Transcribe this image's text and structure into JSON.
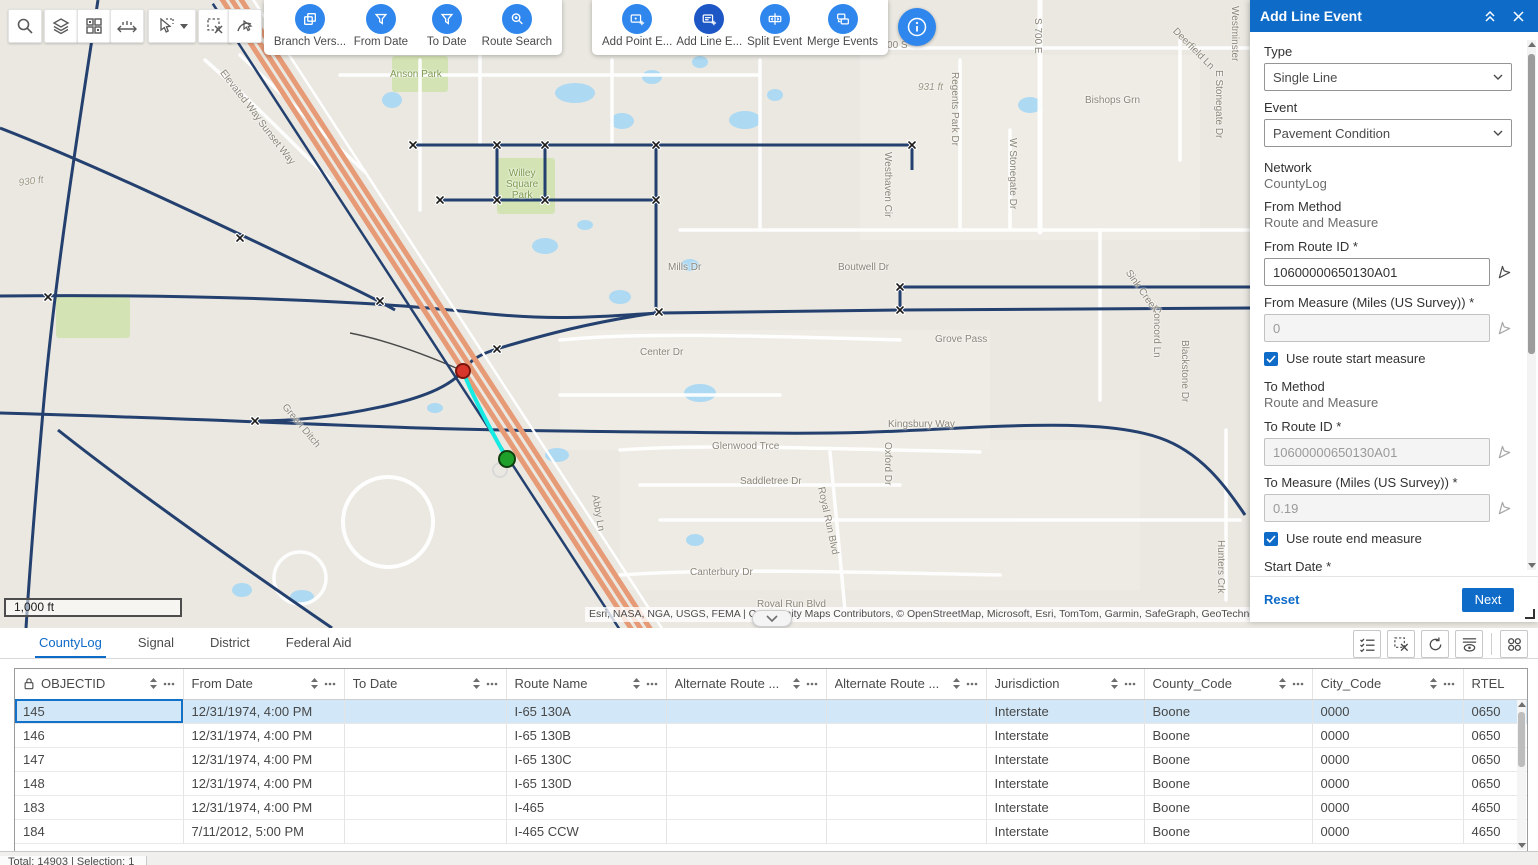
{
  "colors": {
    "accent_blue": "#0e6bc8",
    "toolbar_circle_blue": "#2f87ee",
    "active_circle_blue": "#1d56c5",
    "selected_row": "#d2e8f8",
    "route_navy": "#24406f",
    "highway_orange": "#e69a76",
    "selection_cyan": "#17e9e3",
    "marker_red": "#d8362a",
    "marker_green": "#1ea02b"
  },
  "map": {
    "scale_label": "1,000 ft",
    "attribution": "Esri, NASA, NGA, USGS, FEMA | Community Maps Contributors, © OpenStreetMap, Microsoft, Esri, TomTom, Garmin, SafeGraph, GeoTechnol",
    "labels": [
      {
        "text": "930 ft",
        "x": 18,
        "y": 178,
        "rot": -8,
        "cls": "elev"
      },
      {
        "text": "931 ft",
        "x": 918,
        "y": 82,
        "rot": 0,
        "cls": "elev"
      },
      {
        "text": "Elevated Way",
        "x": 226,
        "y": 68,
        "rot": 52,
        "cls": ""
      },
      {
        "text": "Sunset Way",
        "x": 264,
        "y": 118,
        "rot": 52,
        "cls": ""
      },
      {
        "text": "Anson Park",
        "x": 390,
        "y": 69,
        "rot": 0,
        "cls": "park"
      },
      {
        "text": "Willey\nSquare\nPark",
        "x": 506,
        "y": 168,
        "rot": 0,
        "cls": "park"
      },
      {
        "text": "Mills Dr",
        "x": 668,
        "y": 262,
        "rot": 0,
        "cls": ""
      },
      {
        "text": "E 600 S",
        "x": 872,
        "y": 40,
        "rot": 0,
        "cls": ""
      },
      {
        "text": "S 700 E",
        "x": 1043,
        "y": 18,
        "rot": 90,
        "cls": ""
      },
      {
        "text": "Westhaven Cir",
        "x": 893,
        "y": 152,
        "rot": 90,
        "cls": ""
      },
      {
        "text": "Regents Park Dr",
        "x": 960,
        "y": 72,
        "rot": 90,
        "cls": ""
      },
      {
        "text": "Bishops Grn",
        "x": 1085,
        "y": 95,
        "rot": 0,
        "cls": ""
      },
      {
        "text": "Deerfield Ln",
        "x": 1178,
        "y": 26,
        "rot": 45,
        "cls": ""
      },
      {
        "text": "E Stonegate Dr",
        "x": 1224,
        "y": 70,
        "rot": 90,
        "cls": ""
      },
      {
        "text": "W Stonegate Dr",
        "x": 1018,
        "y": 138,
        "rot": 90,
        "cls": ""
      },
      {
        "text": "Westminster",
        "x": 1240,
        "y": 6,
        "rot": 90,
        "cls": ""
      },
      {
        "text": "Boutwell Dr",
        "x": 838,
        "y": 262,
        "rot": 0,
        "cls": ""
      },
      {
        "text": "Sink Creek",
        "x": 1132,
        "y": 268,
        "rot": 55,
        "cls": ""
      },
      {
        "text": "Grove Pass",
        "x": 935,
        "y": 334,
        "rot": 0,
        "cls": ""
      },
      {
        "text": "Concord Ln",
        "x": 1162,
        "y": 306,
        "rot": 90,
        "cls": ""
      },
      {
        "text": "Blackstone Dr",
        "x": 1190,
        "y": 340,
        "rot": 90,
        "cls": ""
      },
      {
        "text": "Center Dr",
        "x": 640,
        "y": 347,
        "rot": 0,
        "cls": ""
      },
      {
        "text": "Glenwood Trce",
        "x": 712,
        "y": 441,
        "rot": 0,
        "cls": ""
      },
      {
        "text": "Kingsbury Way",
        "x": 888,
        "y": 419,
        "rot": 0,
        "cls": ""
      },
      {
        "text": "Saddletree Dr",
        "x": 740,
        "y": 476,
        "rot": 0,
        "cls": ""
      },
      {
        "text": "Oxford Dr",
        "x": 893,
        "y": 442,
        "rot": 90,
        "cls": ""
      },
      {
        "text": "Royal Run Blvd",
        "x": 826,
        "y": 486,
        "rot": 78,
        "cls": ""
      },
      {
        "text": "Abby Ln",
        "x": 600,
        "y": 494,
        "rot": 80,
        "cls": ""
      },
      {
        "text": "Green Ditch",
        "x": 288,
        "y": 402,
        "rot": 50,
        "cls": ""
      },
      {
        "text": "Canterbury Dr",
        "x": 690,
        "y": 567,
        "rot": 0,
        "cls": ""
      },
      {
        "text": "Royal Run Blvd",
        "x": 757,
        "y": 599,
        "rot": 0,
        "cls": ""
      },
      {
        "text": "Hunters Crk",
        "x": 1226,
        "y": 540,
        "rot": 90,
        "cls": ""
      }
    ]
  },
  "map_toolbars": {
    "left_buttons": [
      "search",
      "layers",
      "basemap-grid",
      "measure",
      "select",
      "clear-selection",
      "select-route"
    ],
    "group1": {
      "buttons": [
        {
          "label": "Branch Vers...",
          "icon": "branch-versions"
        },
        {
          "label": "From Date",
          "icon": "from-date-filter"
        },
        {
          "label": "To Date",
          "icon": "to-date-filter"
        },
        {
          "label": "Route Search",
          "icon": "route-search"
        }
      ]
    },
    "group2": {
      "buttons": [
        {
          "label": "Add Point E...",
          "icon": "add-point-event"
        },
        {
          "label": "Add Line E...",
          "icon": "add-line-event",
          "active": true
        },
        {
          "label": "Split Event",
          "icon": "split-event"
        },
        {
          "label": "Merge Events",
          "icon": "merge-events"
        }
      ]
    },
    "info_icon": "info"
  },
  "panel": {
    "title": "Add Line Event",
    "type_label": "Type",
    "type_value": "Single Line",
    "event_label": "Event",
    "event_value": "Pavement Condition",
    "network_label": "Network",
    "network_value": "CountyLog",
    "from_method_label": "From Method",
    "from_method_value": "Route and Measure",
    "from_route_label": "From Route ID *",
    "from_route_value": "10600000650130A01",
    "from_measure_label": "From Measure (Miles (US Survey)) *",
    "from_measure_value": "0",
    "use_route_start_measure": "Use route start measure",
    "use_route_start_measure_checked": true,
    "to_method_label": "To Method",
    "to_method_value": "Route and Measure",
    "to_route_label": "To Route ID *",
    "to_route_value": "10600000650130A01",
    "to_measure_label": "To Measure (Miles (US Survey)) *",
    "to_measure_value": "0.19",
    "use_route_end_measure": "Use route end measure",
    "use_route_end_measure_checked": true,
    "start_date_label": "Start Date *",
    "start_date_value": "9/16/2024",
    "use_route_start_date": "Use route start date",
    "use_route_start_date_checked": false,
    "end_date_label": "End Date",
    "end_date_placeholder": "MM/DD/YYYY",
    "use_route_end_date": "Use route end date",
    "use_route_end_date_checked": false,
    "reset_label": "Reset",
    "next_label": "Next"
  },
  "tabs": [
    {
      "label": "CountyLog",
      "active": true
    },
    {
      "label": "Signal",
      "active": false
    },
    {
      "label": "District",
      "active": false
    },
    {
      "label": "Federal Aid",
      "active": false
    }
  ],
  "table_toolbar_icons": [
    "show-selection",
    "clear-selection",
    "refresh",
    "show-hide-columns",
    "options-grid"
  ],
  "table": {
    "columns": [
      "OBJECTID",
      "From Date",
      "To Date",
      "Route Name",
      "Alternate Route ...",
      "Alternate Route ...",
      "Jurisdiction",
      "County_Code",
      "City_Code",
      "RTEL"
    ],
    "selected_row_index": 0,
    "rows": [
      {
        "cells": [
          "145",
          "12/31/1974, 4:00 PM",
          "",
          "I-65 130A",
          "",
          "",
          "Interstate",
          "Boone",
          "0000",
          "0650"
        ]
      },
      {
        "cells": [
          "146",
          "12/31/1974, 4:00 PM",
          "",
          "I-65 130B",
          "",
          "",
          "Interstate",
          "Boone",
          "0000",
          "0650"
        ]
      },
      {
        "cells": [
          "147",
          "12/31/1974, 4:00 PM",
          "",
          "I-65 130C",
          "",
          "",
          "Interstate",
          "Boone",
          "0000",
          "0650"
        ]
      },
      {
        "cells": [
          "148",
          "12/31/1974, 4:00 PM",
          "",
          "I-65 130D",
          "",
          "",
          "Interstate",
          "Boone",
          "0000",
          "0650"
        ]
      },
      {
        "cells": [
          "183",
          "12/31/1974, 4:00 PM",
          "",
          "I-465",
          "",
          "",
          "Interstate",
          "Boone",
          "0000",
          "4650"
        ]
      },
      {
        "cells": [
          "184",
          "7/11/2012, 5:00 PM",
          "",
          "I-465 CCW",
          "",
          "",
          "Interstate",
          "Boone",
          "0000",
          "4650"
        ]
      }
    ]
  },
  "status_bar": {
    "text": "Total: 14903 | Selection: 1"
  }
}
